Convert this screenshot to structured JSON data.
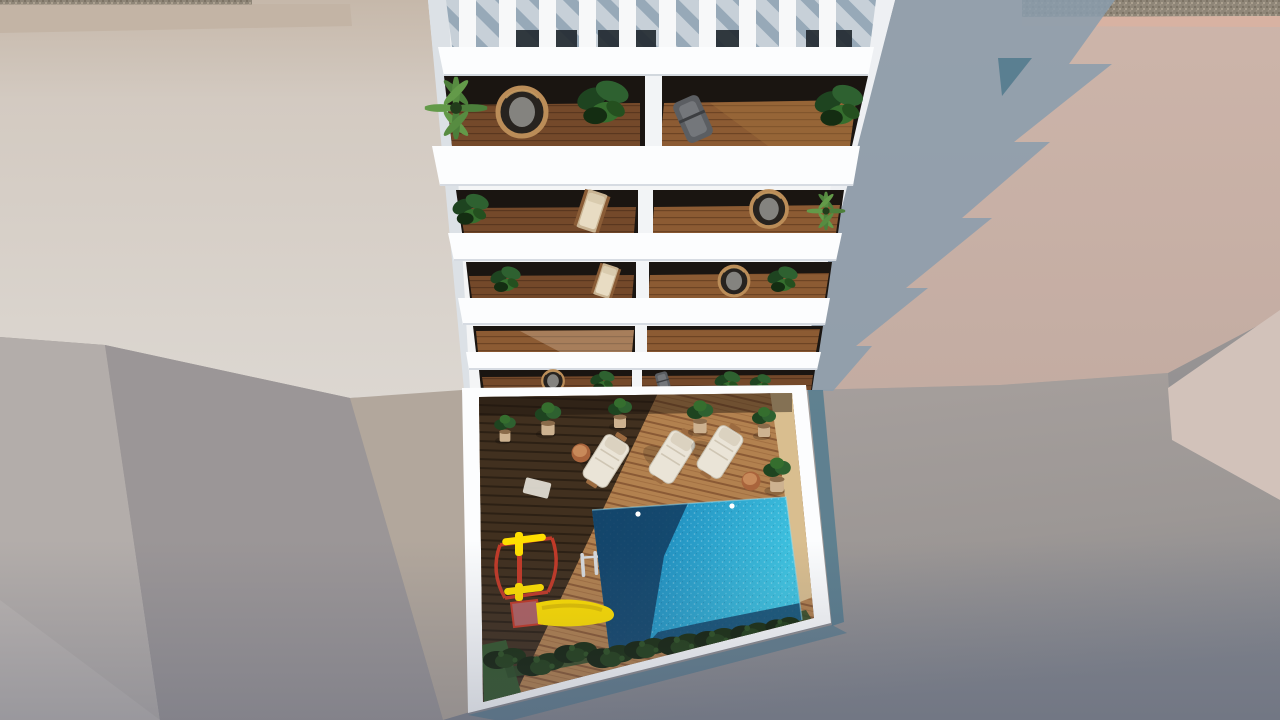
{
  "scene": {
    "alt": "Aerial top-down 3D architectural rendering of a white apartment tower with plant-filled balconies above a courtyard with swimming pool, sun loungers and a yellow playground slide",
    "building": {
      "pergola_slats": 10,
      "balcony_levels": 5,
      "units_per_level": 2
    },
    "courtyard": {
      "sun_loungers": 3,
      "side_tables": 2,
      "potted_plants": 6,
      "pool_lights": 2,
      "pool_ladders": 1
    },
    "colors": {
      "beige_top": "#c3b4a5",
      "beige_main": "#d5cdc4",
      "gravel": "#8f8678",
      "pink_trim": "#d8b2a2",
      "pink_wall": "#c9b2a8",
      "pink_wall_light": "#d2c2ba",
      "shadow_blue": "#8a9cad",
      "shadow_teal": "#547b8e",
      "ground_grey": "#a39c99",
      "wall_grey_light": "#b3adaa",
      "wall_grey_mid": "#9b9697",
      "wall_grey_sliver": "#b2a79c",
      "wall_grey_corner": "#bab4b1",
      "building_white": "#f4f5f6",
      "building_face_shade": "#dce1e6",
      "slab_white": "#fcfdfe",
      "balcony_interior": "#1a1511",
      "sand_band": "#d9be8f",
      "pool_shadow": "#123f63",
      "grass": "#35572c",
      "slide_yellow": "#ffdf00",
      "frame_red": "#c23a28",
      "cube_pink": "#b06263",
      "ladder_silver": "#d6d9dc",
      "table_terracotta": "#a9643c",
      "pool_light_dot": "#ffffff"
    }
  }
}
